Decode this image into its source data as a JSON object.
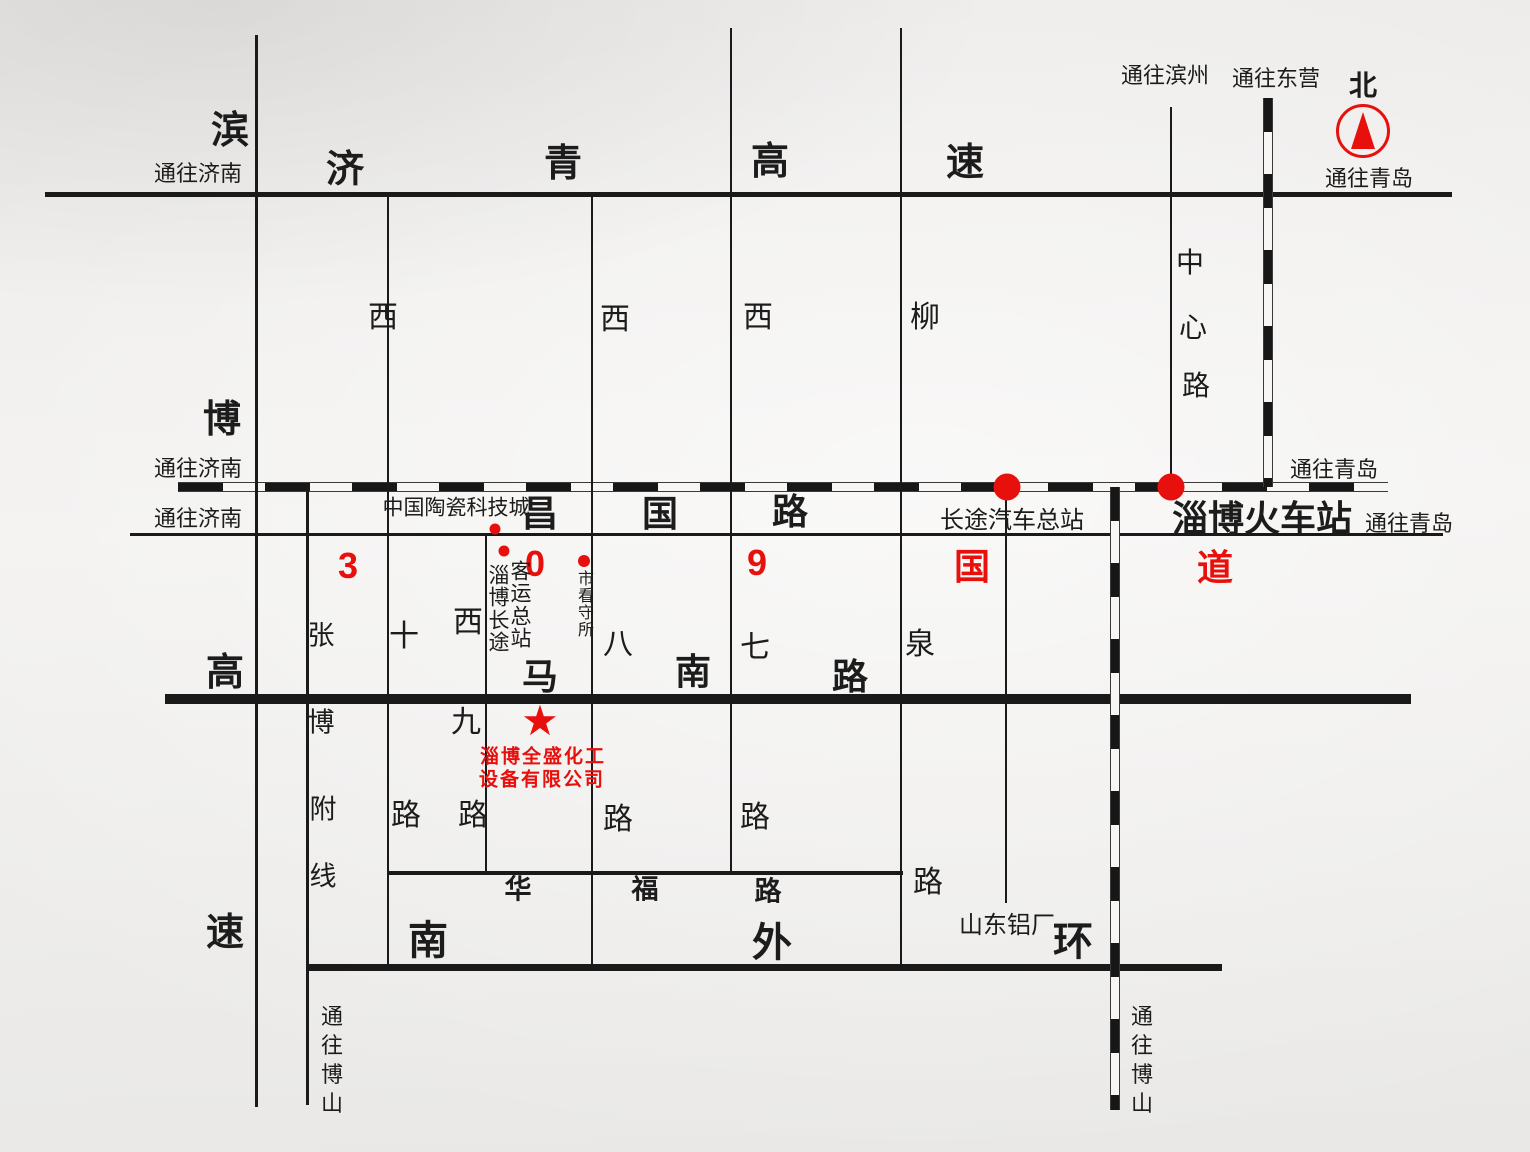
{
  "palette": {
    "red": "#e8100c",
    "ink": "#1c1c1c"
  },
  "compass": {
    "north_label": "北"
  },
  "directions": {
    "to_jinan_expwy": "通往济南",
    "to_jinan_rail": "通往济南",
    "to_jinan_road": "通往济南",
    "to_binzhou": "通往滨州",
    "to_dongying": "通往东营",
    "to_qingdao_compass": "通往青岛",
    "to_qingdao_rail": "通往青岛",
    "to_qingdao_road": "通往青岛",
    "to_boshan_west": "通往博山",
    "to_boshan_rail": "通往博山"
  },
  "expressways": {
    "jiqing": {
      "chars": [
        "济",
        "青",
        "高",
        "速"
      ]
    },
    "binbo": {
      "chars": [
        "滨",
        "博",
        "高",
        "速"
      ]
    }
  },
  "roads": {
    "zhangbo_branch": {
      "chars": [
        "张",
        "博",
        "附",
        "线"
      ]
    },
    "changguo": {
      "chars": [
        "昌",
        "国",
        "路"
      ]
    },
    "g309": {
      "chars": [
        "3",
        "0",
        "9",
        "国",
        "道"
      ]
    },
    "manan": {
      "chars": [
        "马",
        "南",
        "路"
      ]
    },
    "huafu": {
      "chars": [
        "华",
        "福",
        "路"
      ]
    },
    "south_ring": {
      "chars": [
        "南",
        "外",
        "环"
      ]
    },
    "xishi": {
      "chars": [
        "西",
        "十",
        "路"
      ]
    },
    "xijiu": {
      "chars": [
        "西",
        "九",
        "路"
      ]
    },
    "xiba": {
      "chars": [
        "西",
        "八",
        "路"
      ]
    },
    "xiqi": {
      "chars": [
        "西",
        "七",
        "路"
      ]
    },
    "liuquan": {
      "chars": [
        "柳",
        "泉",
        "路"
      ]
    },
    "zhongxin": {
      "chars": [
        "中",
        "心",
        "路"
      ]
    }
  },
  "landmarks": {
    "ceramics_city": "中国陶瓷科技城",
    "bus_terminal_col1": "淄博长途",
    "bus_terminal_col2": "客运总站",
    "detention_house": "市看守所",
    "coach_station": "长途汽车总站",
    "railway_station": "淄博火车站",
    "aluminum_plant": "山东铝厂"
  },
  "company": {
    "marker": "★",
    "name_line1": "淄博全盛化工",
    "name_line2": "设备有限公司"
  }
}
